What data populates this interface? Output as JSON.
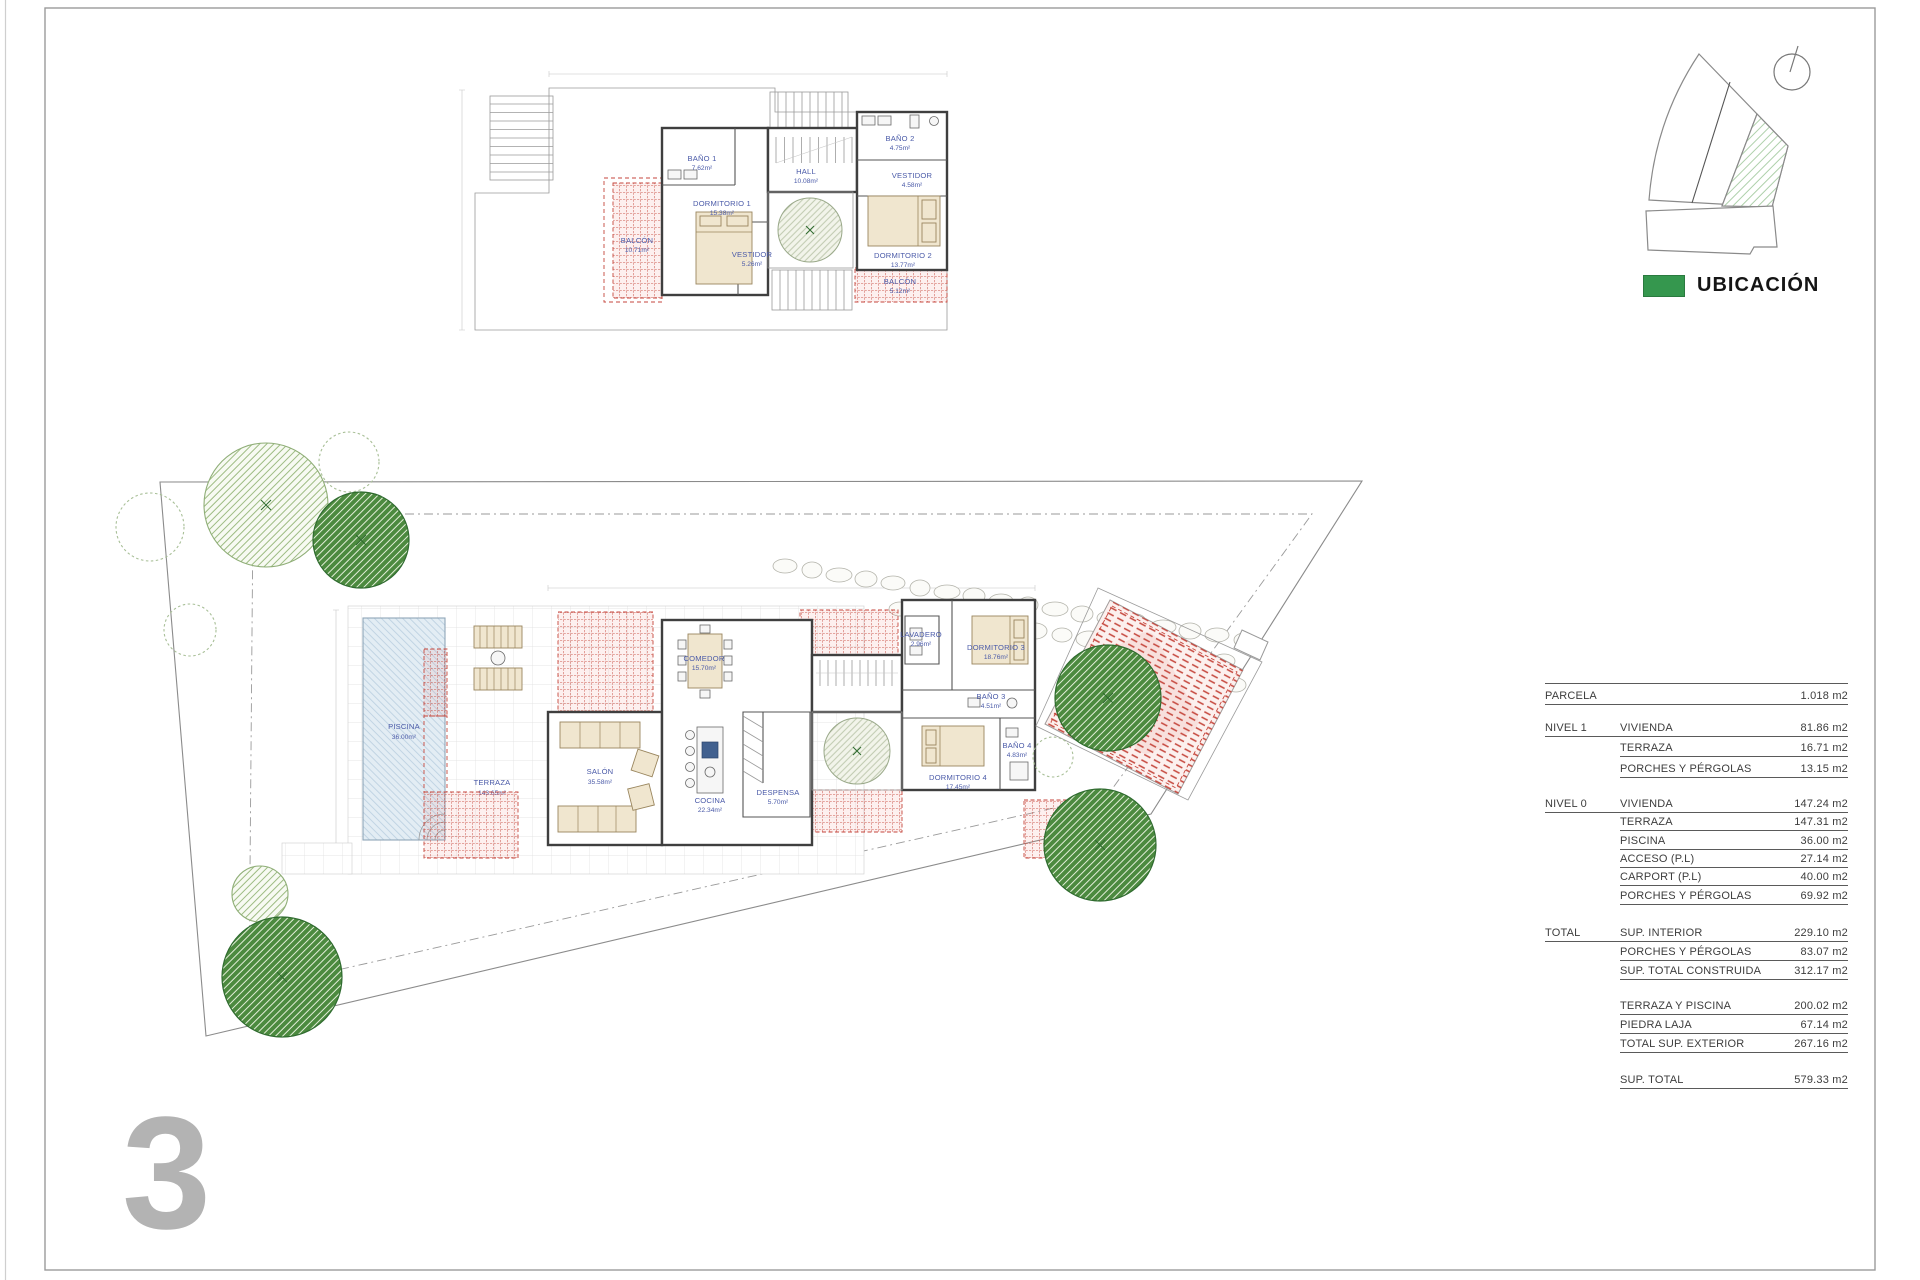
{
  "sheet": {
    "number": "3"
  },
  "location": {
    "legend_label": "UBICACIÓN",
    "legend_color": "#35974e"
  },
  "colors": {
    "red_hatch": "#c5463c",
    "tree_green": "#4c8a3f",
    "pool_blue": "#e3edf4",
    "room_label_blue": "#4a5aa8",
    "sheet_number_gray": "#b3b3b3"
  },
  "upper_plan": {
    "rooms": {
      "banio1": {
        "name": "BAÑO 1",
        "area": "7.62m²"
      },
      "dormitorio1": {
        "name": "DORMITORIO 1",
        "area": "15.38m²"
      },
      "vestidor1": {
        "name": "VESTIDOR",
        "area": "5.26m²"
      },
      "hall": {
        "name": "HALL",
        "area": "10.08m²"
      },
      "banio2": {
        "name": "BAÑO 2",
        "area": "4.75m²"
      },
      "vestidor2": {
        "name": "VESTIDOR",
        "area": "4.58m²"
      },
      "dormitorio2": {
        "name": "DORMITORIO 2",
        "area": "13.77m²"
      },
      "balcon1": {
        "name": "BALCÓN",
        "area": "10.71m²"
      },
      "balcon2": {
        "name": "BALCÓN",
        "area": "5.12m²"
      }
    }
  },
  "ground_plan": {
    "rooms": {
      "salon": {
        "name": "SALÓN",
        "area": "35.58m²"
      },
      "comedor": {
        "name": "COMEDOR",
        "area": "15.70m²"
      },
      "cocina": {
        "name": "COCINA",
        "area": "22.34m²"
      },
      "despensa": {
        "name": "DESPENSA",
        "area": "5.70m²"
      },
      "lavadero": {
        "name": "LAVADERO",
        "area": "2.96m²"
      },
      "dormitorio3": {
        "name": "DORMITORIO 3",
        "area": "18.76m²"
      },
      "banio3": {
        "name": "BAÑO 3",
        "area": "4.51m²"
      },
      "dormitorio4": {
        "name": "DORMITORIO 4",
        "area": "17.45m²"
      },
      "banio4": {
        "name": "BAÑO 4",
        "area": "4.83m²"
      },
      "piscina": {
        "name": "PISCINA",
        "area": "36.00m²"
      },
      "terraza": {
        "name": "TERRAZA",
        "area": "143.65m²"
      }
    }
  },
  "area_table": {
    "rows": [
      {
        "label": "PARCELA",
        "sublabel": "",
        "value": "1.018 m2"
      },
      {
        "label": "NIVEL 1",
        "sublabel": "VIVIENDA",
        "value": "81.86 m2"
      },
      {
        "label": "",
        "sublabel": "TERRAZA",
        "value": "16.71 m2"
      },
      {
        "label": "",
        "sublabel": "PORCHES Y PÉRGOLAS",
        "value": "13.15 m2"
      },
      {
        "label": "NIVEL 0",
        "sublabel": "VIVIENDA",
        "value": "147.24 m2"
      },
      {
        "label": "",
        "sublabel": "TERRAZA",
        "value": "147.31 m2"
      },
      {
        "label": "",
        "sublabel": "PISCINA",
        "value": "36.00 m2"
      },
      {
        "label": "",
        "sublabel": "ACCESO (P.L)",
        "value": "27.14 m2"
      },
      {
        "label": "",
        "sublabel": "CARPORT (P.L)",
        "value": "40.00 m2"
      },
      {
        "label": "",
        "sublabel": "PORCHES Y PÉRGOLAS",
        "value": "69.92 m2"
      },
      {
        "label": "TOTAL",
        "sublabel": "SUP. INTERIOR",
        "value": "229.10 m2"
      },
      {
        "label": "",
        "sublabel": "PORCHES Y PÉRGOLAS",
        "value": "83.07 m2"
      },
      {
        "label": "",
        "sublabel": "SUP. TOTAL CONSTRUIDA",
        "value": "312.17 m2"
      },
      {
        "label": "",
        "sublabel": "TERRAZA Y PISCINA",
        "value": "200.02 m2"
      },
      {
        "label": "",
        "sublabel": "PIEDRA LAJA",
        "value": "67.14 m2"
      },
      {
        "label": "",
        "sublabel": "TOTAL SUP. EXTERIOR",
        "value": "267.16 m2"
      },
      {
        "label": "",
        "sublabel": "SUP. TOTAL",
        "value": "579.33 m2"
      }
    ]
  }
}
